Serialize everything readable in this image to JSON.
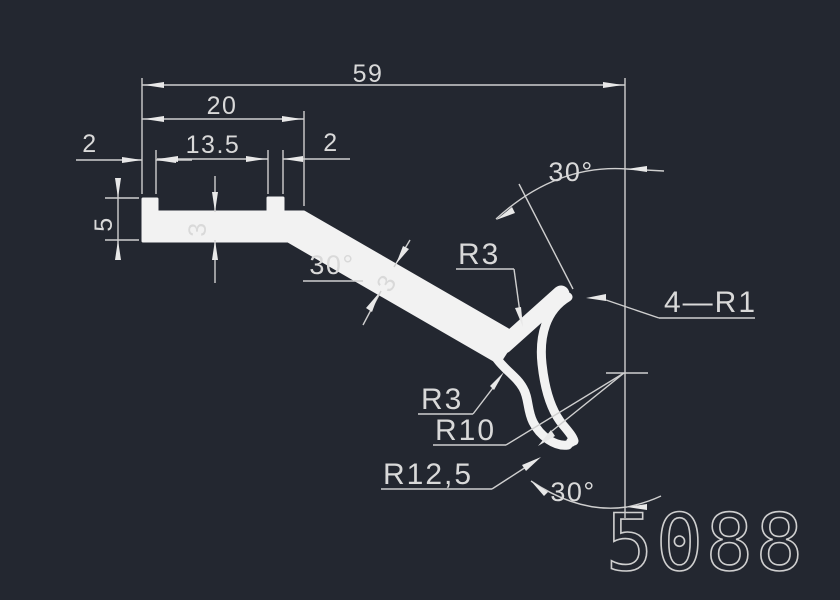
{
  "drawing": {
    "part_number": "5088",
    "labels": {
      "d59": "59",
      "d20": "20",
      "d13_5": "13.5",
      "d2_left": "2",
      "d2_right": "2",
      "d5": "5",
      "d3_floor": "3",
      "d3_wall": "3",
      "angle_slope": "30°",
      "angle_top": "30°",
      "angle_bottom": "30°",
      "r3_upper": "R3",
      "r3_lower": "R3",
      "r10": "R10",
      "r12_5": "R12,5",
      "four_r1": "4—R1"
    },
    "colors": {
      "background": "#232730",
      "profile_line": "#f2f2f2",
      "dimension_line": "#cfcfcf",
      "text": "#d9d9d9"
    }
  }
}
